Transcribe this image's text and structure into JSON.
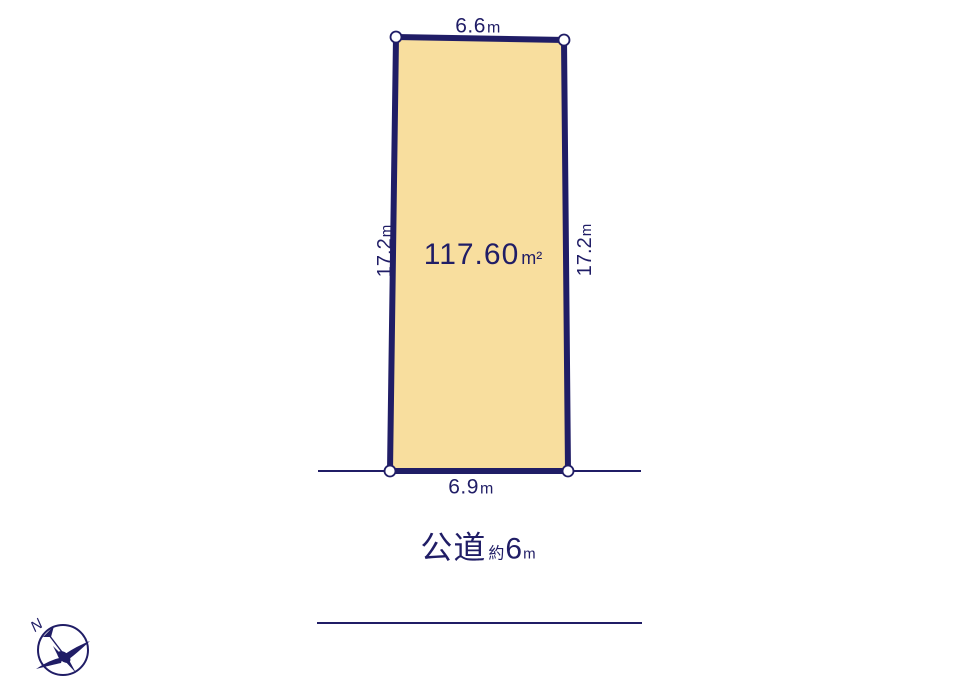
{
  "diagram_title": "land-parcel-site-plan",
  "colors": {
    "outline_navy": "#201d66",
    "parcel_fill": "#f8de9e",
    "corner_marker_fill": "#ffffff",
    "background": "#ffffff"
  },
  "parcel": {
    "area": {
      "value": "117.60",
      "unit": "m²"
    },
    "dim_top": {
      "value": "6.6",
      "unit": "m"
    },
    "dim_bottom": {
      "value": "6.9",
      "unit": "m"
    },
    "dim_left": {
      "value": "17.2",
      "unit": "m"
    },
    "dim_right": {
      "value": "17.2",
      "unit": "m"
    }
  },
  "road": {
    "type_label": "公道",
    "approx_label": "約",
    "width_value": "6",
    "width_unit": "m"
  },
  "compass": {
    "north_label": "N"
  }
}
